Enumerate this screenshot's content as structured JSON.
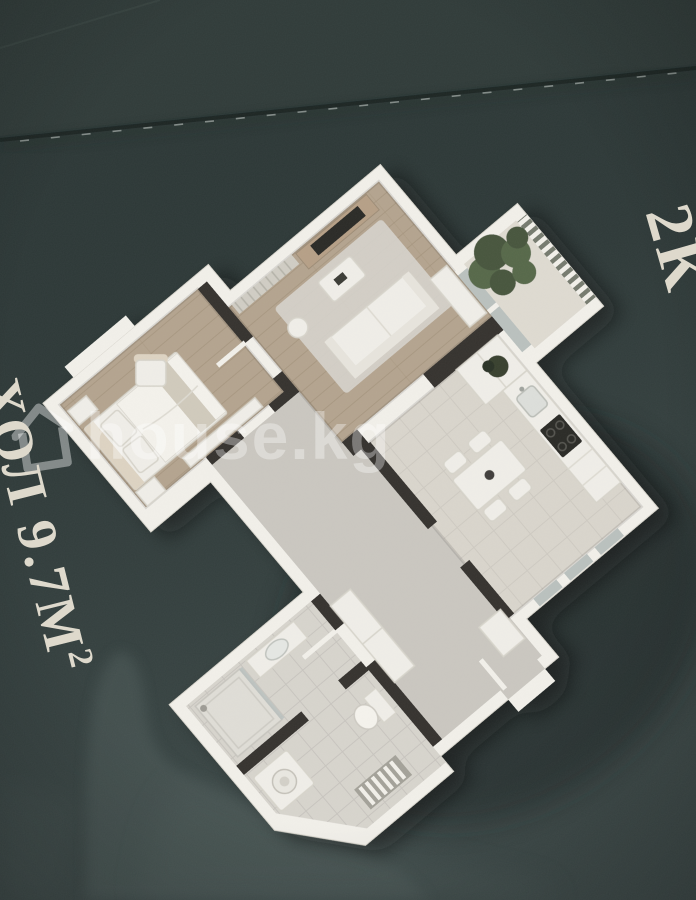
{
  "labels": {
    "room_area_label": "ХОЛ 9.7М²",
    "room_area_label_main": "ХОЛ 9.7М",
    "room_area_label_sup": "2",
    "edge_partial_label": "2К"
  },
  "watermark": {
    "text": "house.kg",
    "icon": "house-icon"
  },
  "floor_plan": {
    "type": "3d-apartment-floor-plan-render",
    "rotation_deg": -40,
    "rooms": [
      "bedroom",
      "living-room",
      "balcony",
      "kitchen-dining",
      "hallway",
      "bathroom",
      "laundry-wc"
    ]
  },
  "palette": {
    "bg-top": "#313c3a",
    "bg-main": "#2c3737",
    "bg-bottom": "#414d4b",
    "swoosh": "#4d5a58",
    "plan-shadow": "#141d1c",
    "crease-dark": "#18211f",
    "crease-glint": "#d7ded9",
    "plan-wall-white": "#f1efe9",
    "wall-stroke": "#d9d6cd",
    "interior-wall-dark": "#36332e",
    "wood-floor": "#b3a38e",
    "wood-line": "#9d8c76",
    "gray-floor": "#c9c6bf",
    "tile-floor": "#d6d3cc",
    "kitchen-floor": "#d8d4cb",
    "balcony-floor": "#ddd9d0",
    "rug": "#d5d2cb",
    "furniture-white": "#efede7",
    "furniture-stroke": "#d6d3ca",
    "furniture-beige": "#dcd2c1",
    "wood-furniture": "#b59f86",
    "tv-dark": "#2b2a27",
    "plant-green": "#56674a",
    "plant-green-dark": "#46553c",
    "plant-pot-dark": "#39402f",
    "glass": "#b9c0bd",
    "railing-base": "#757a6e",
    "label-text": "#ded9cc",
    "watermark-white": "rgba(255,255,255,0.34)"
  }
}
